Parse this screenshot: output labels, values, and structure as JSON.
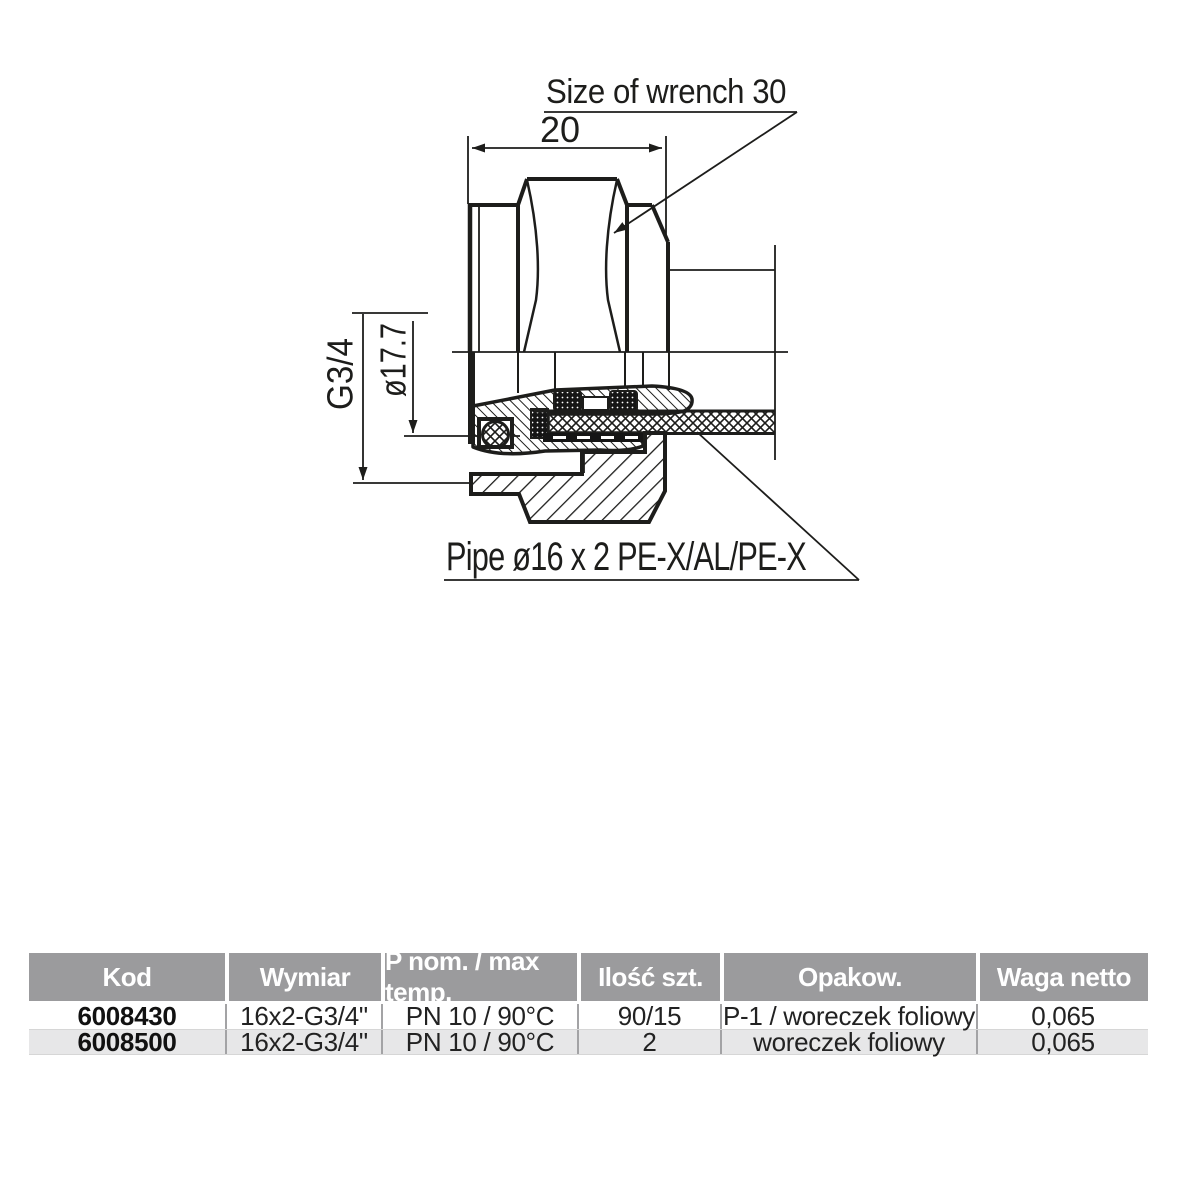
{
  "drawing": {
    "labels": {
      "wrench": "Size of wrench 30",
      "width_dim": "20",
      "thread": "G3/4",
      "diameter": "ø17.7",
      "pipe": "Pipe ø16 x 2 PE-X/AL/PE-X"
    }
  },
  "theme": {
    "header_bg": "#9b9b9d",
    "row_alt_bg": "#e7e7e8",
    "header_text": "#ffffff",
    "line_color": "#1d1d1b",
    "body_text": "#222222"
  },
  "table": {
    "columns": [
      "Kod",
      "Wymiar",
      "P nom. / max temp.",
      "Ilość szt.",
      "Opakow.",
      "Waga netto"
    ],
    "rows": [
      [
        "6008430",
        "16x2-G3/4\"",
        "PN 10 / 90°C",
        "90/15",
        "P-1 / woreczek foliowy",
        "0,065"
      ],
      [
        "6008500",
        "16x2-G3/4\"",
        "PN 10 / 90°C",
        "2",
        "woreczek foliowy",
        "0,065"
      ]
    ]
  }
}
